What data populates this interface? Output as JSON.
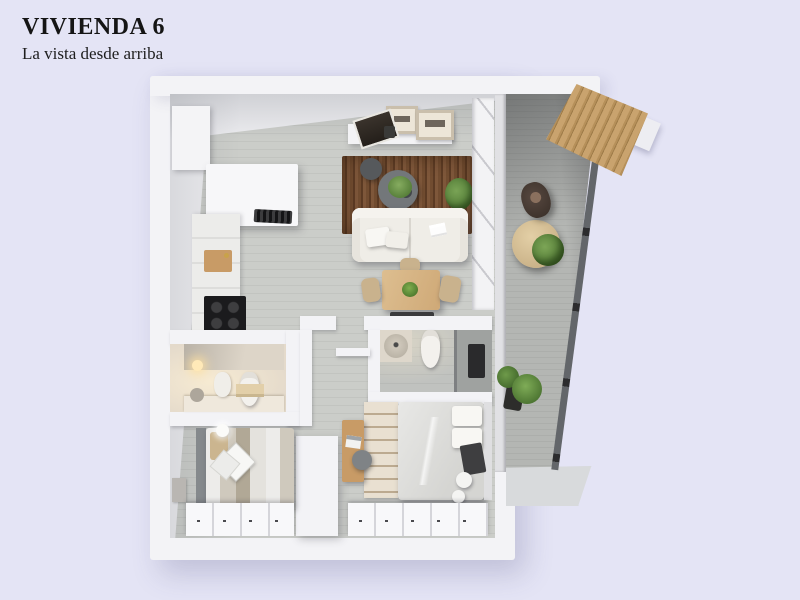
{
  "header": {
    "title": "VIVIENDA 6",
    "subtitle": "La vista desde arriba"
  },
  "palette": {
    "bg": "#E4E4F5",
    "wall": "#F3F3F6",
    "wallface": "#EDEDF0",
    "floor": "#CBCDC9",
    "floorline": "#C2C4C0",
    "balfloor": "#B4B6B3",
    "wood": "#C89B66",
    "rug": "#6E4A30",
    "sofa": "#EFEDE7",
    "green": "#5B8A43",
    "dark": "#1B1B1D",
    "beige": "#C9B28D",
    "white": "#F8F8FA"
  }
}
